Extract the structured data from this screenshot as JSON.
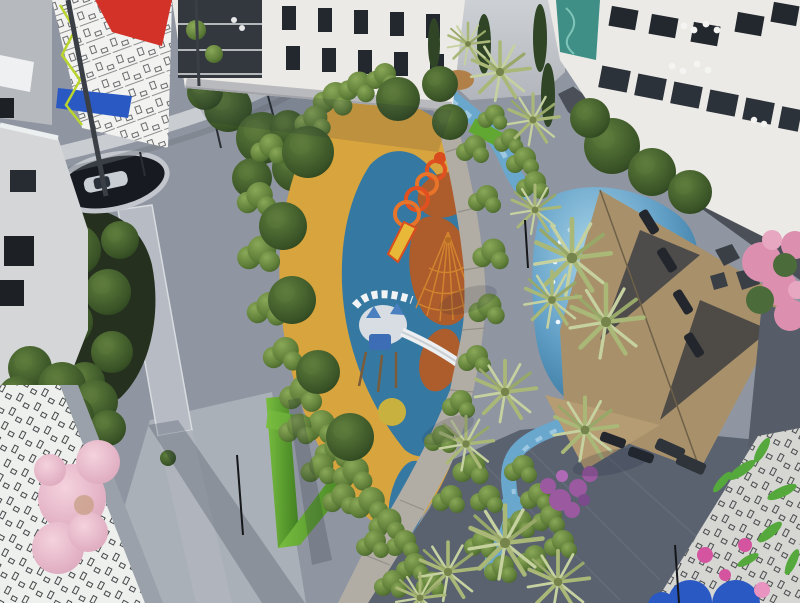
{
  "scene": {
    "description": "Aerial 3D architectural rendering of a residential courtyard",
    "regions": {
      "top_left": "apartment tower with red, blue and black line-art mural",
      "top_center": "white apartment building with recessed balconies and planted terraces",
      "top_right": "white apartment building with glass balconies and roof terraces",
      "center": "leaf-shaped playground with blue, yellow and terracotta safety surfacing, caterpillar arches, spider-web climber and castle tower with white slide",
      "left": "grey paved plaza with oval skylight opening over a parked car and a sunken dark garden",
      "right": "free-form pool with edge lights, tan shade sails, sun loungers and rocks",
      "bottom_left": "black-and-white isometric city mural wall with pink blossom tree",
      "bottom_right": "rooftop mural with line-art buildings, blue arcs, green leaves and pink flowers",
      "paths": "stone-slab walkway winding between palm trees and a blue stream"
    }
  },
  "palette": {
    "pavement_light": "#aeb4bb",
    "pavement_mid": "#8f96a1",
    "pavement_dark": "#5a6270",
    "building_white": "#eceae6",
    "mural_red": "#d23227",
    "mural_blue": "#2b59c3",
    "mural_lime": "#b9d42d",
    "play_blue": "#3579a3",
    "play_yellow": "#d8a43e",
    "play_terracotta": "#ad5c2c",
    "web_orange": "#d2832e",
    "caterpillar_red": "#e05020",
    "pool_blue": "#4988b4",
    "water_stream": "#6aa7cc",
    "sail_tan": "#a8916a",
    "canopy_slate": "#4a4f58",
    "hedge_green": "#61a832",
    "foliage_dark": "#3f5a2e",
    "palm_pale": "#aab873",
    "pink_blossom": "#ecbccd",
    "flower_pink": "#dc8fae",
    "flower_purple": "#9b59a0",
    "skylight_dark": "#171b21"
  }
}
